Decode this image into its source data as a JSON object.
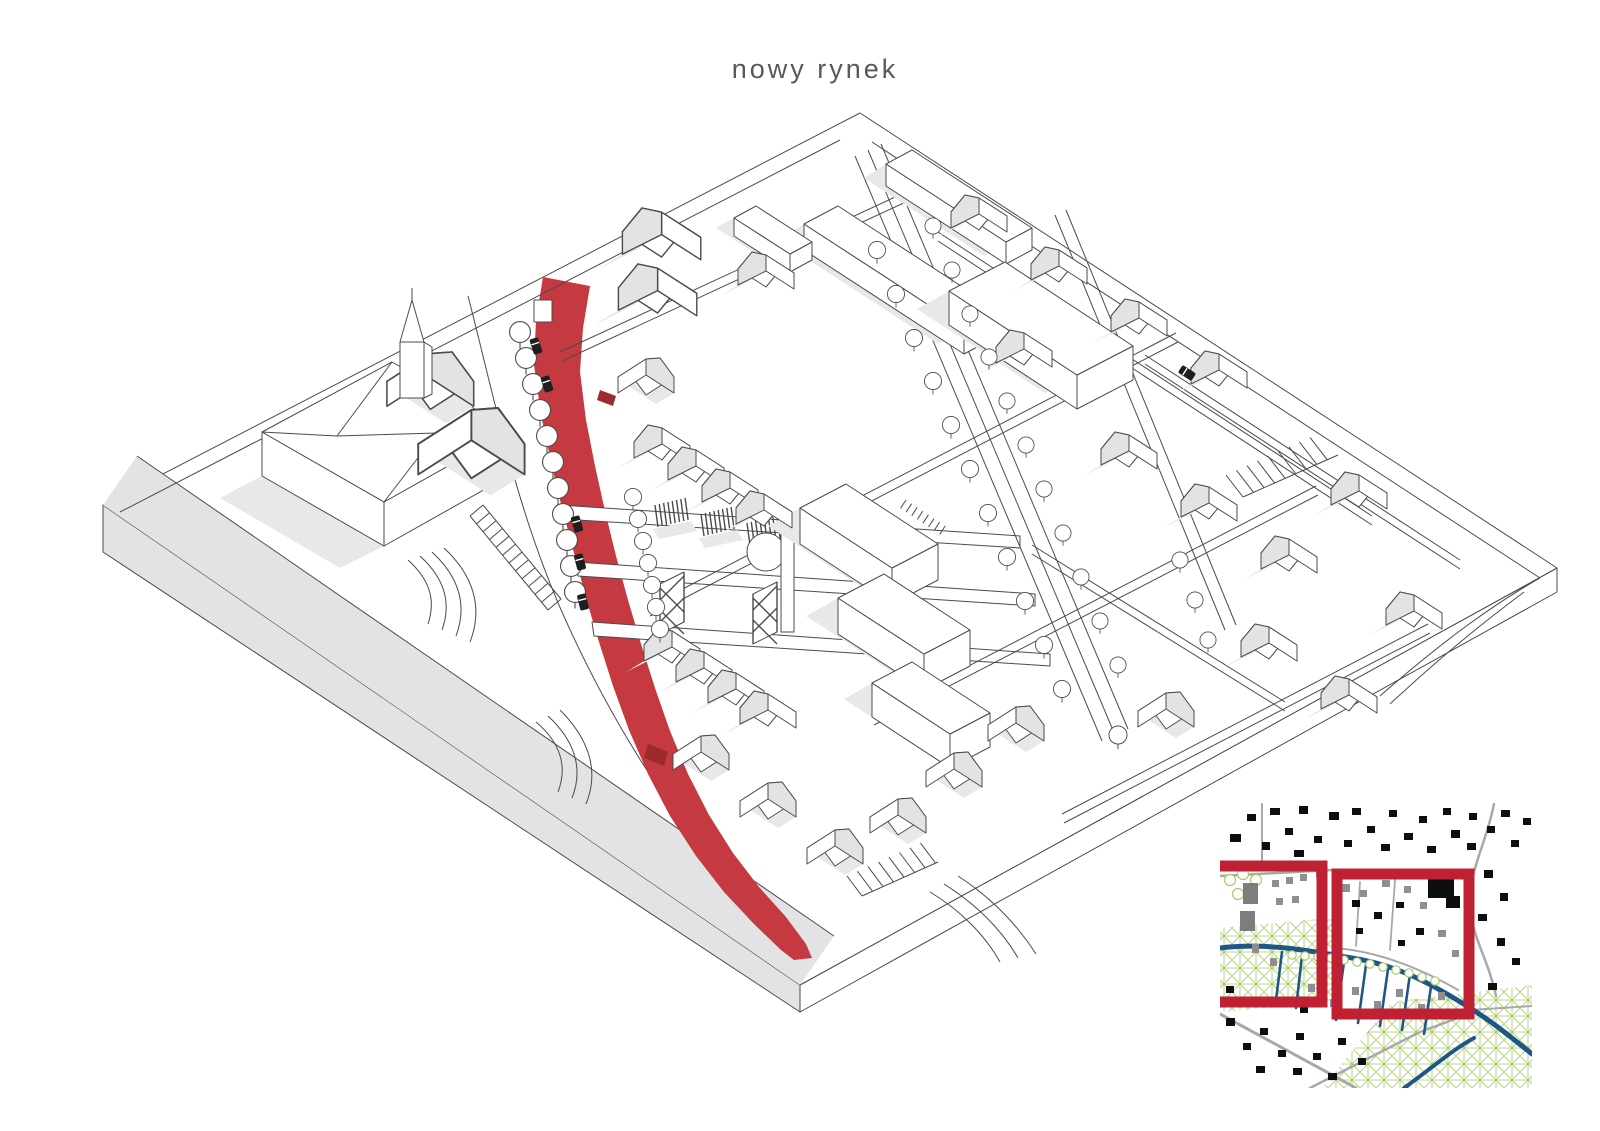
{
  "title": {
    "text": "nowy rynek"
  },
  "colors": {
    "background": "#ffffff",
    "title_gray": "#59595b",
    "line": "#4b4b4d",
    "shade": "#e3e3e5",
    "shadow": "#e8e8ea",
    "highlight_red": "#c43a40",
    "highlight_red_dark": "#9c2b30",
    "inset_red": "#bf2032",
    "map_road_gray": "#a8a8a8",
    "map_green": "#a9cc66",
    "map_blue": "#1d5687",
    "map_black": "#0e0e0e",
    "map_gray_building": "#7d7d7d"
  },
  "inset_map": {
    "highlight_frames": 2
  }
}
